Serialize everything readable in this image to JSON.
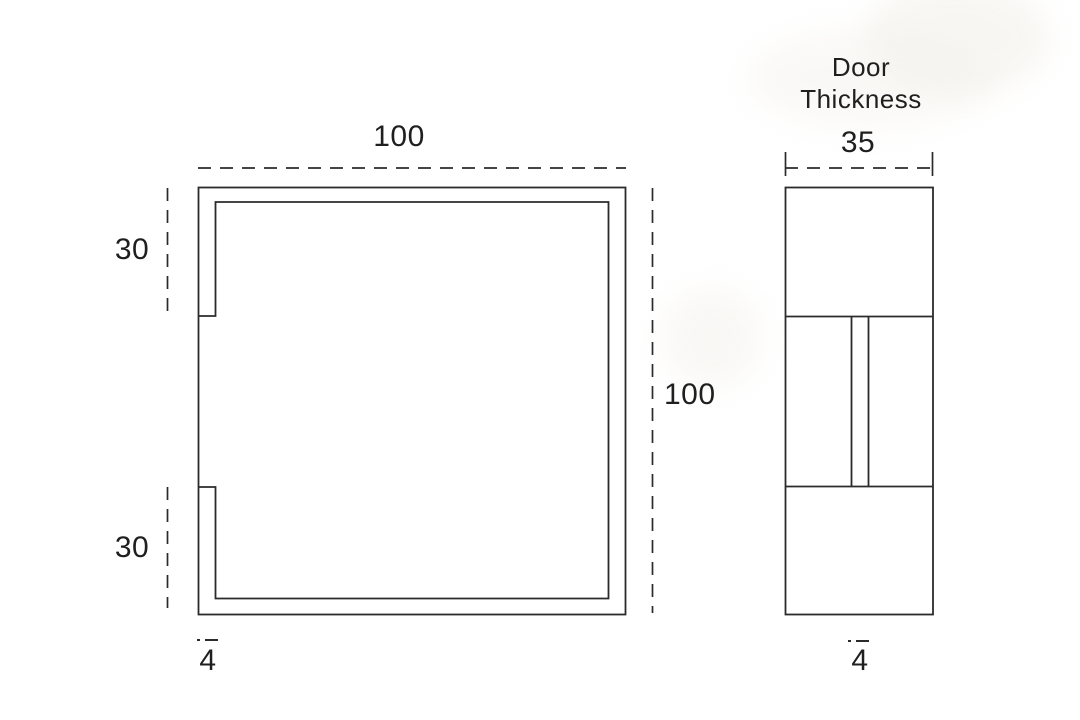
{
  "front_view": {
    "width_label": "100",
    "height_label": "100",
    "top_inset_label": "30",
    "bottom_inset_label": "30",
    "edge_thickness_label": "4"
  },
  "side_view": {
    "title_line1": "Door",
    "title_line2": "Thickness",
    "width_label": "35",
    "plate_thickness_label": "4"
  },
  "colors": {
    "line": "#2b2b2b",
    "text": "#1f1f1f",
    "background": "#ffffff",
    "smudge": "#f3f0ea"
  }
}
